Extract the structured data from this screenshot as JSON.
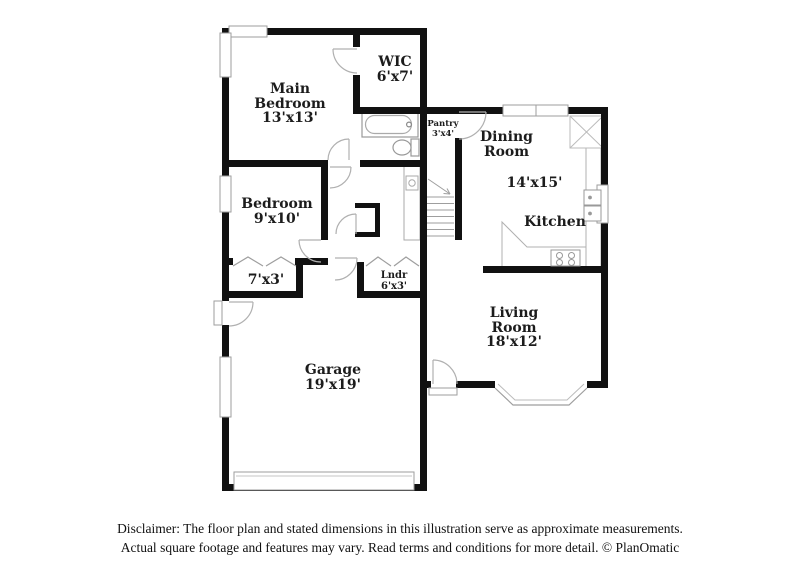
{
  "title": "Floor plan",
  "rooms": [
    {
      "name": "Main Bedroom",
      "dims": "13'x13'"
    },
    {
      "name": "WIC",
      "dims": "6'x7'"
    },
    {
      "name": "Pantry",
      "dims": "3'x4'"
    },
    {
      "name": "Dining Room",
      "dims": "14'x15'"
    },
    {
      "name": "Kitchen",
      "dims": ""
    },
    {
      "name": "Bedroom",
      "dims": "9'x10'"
    },
    {
      "name": "",
      "dims": "7'x3'"
    },
    {
      "name": "Lndr",
      "dims": "6'x3'"
    },
    {
      "name": "Living Room",
      "dims": "18'x12'"
    },
    {
      "name": "Garage",
      "dims": "19'x19'"
    }
  ],
  "disclaimer": {
    "line1": "Disclaimer: The floor plan and stated dimensions in this illustration serve as approximate measurements.",
    "line2": "Actual square footage and features may vary. Read terms and conditions for more detail. © PlanOmatic"
  },
  "colors": {
    "wall": "#111111",
    "fixture_outline": "#9e9e9e",
    "text": "#1c1c1c",
    "background": "#ffffff"
  }
}
